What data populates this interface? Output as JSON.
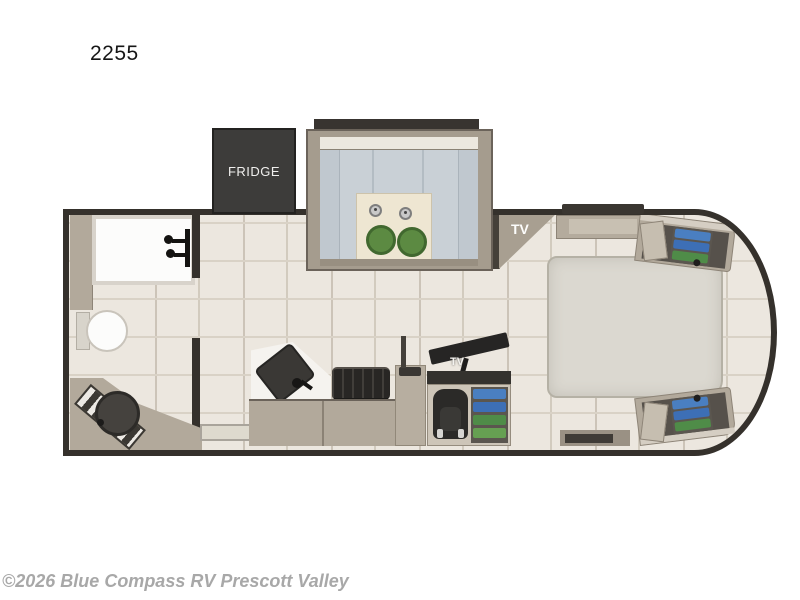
{
  "title": {
    "label": "2255"
  },
  "watermark": {
    "label": "©2026 Blue Compass RV Prescott Valley"
  },
  "floorplan": {
    "fridge_label": "FRIDGE",
    "tv_corner_label": "TV",
    "tv_wardrobe_label": "TV",
    "colors": {
      "wall": "#35312c",
      "floor": "#ece7df",
      "plank_line": "#d9d2c6",
      "cabinet": "#b2a99b",
      "cabinet_dark": "#8d8477",
      "cushion": "#c9d0d6",
      "table": "#eee6d2",
      "stool_green": "#5c8a42",
      "bed": "#dbd8d0",
      "fridge": "#3d3c3a",
      "tv_dark": "#262524",
      "shelf_blue": "#4a7fc1",
      "shelf_blue2": "#3d6fb6",
      "shelf_green": "#4f8c48",
      "white_fixture": "#fcfcfb",
      "sink_dark": "#45423e",
      "watermark_gray": "#a8a8a8"
    }
  }
}
